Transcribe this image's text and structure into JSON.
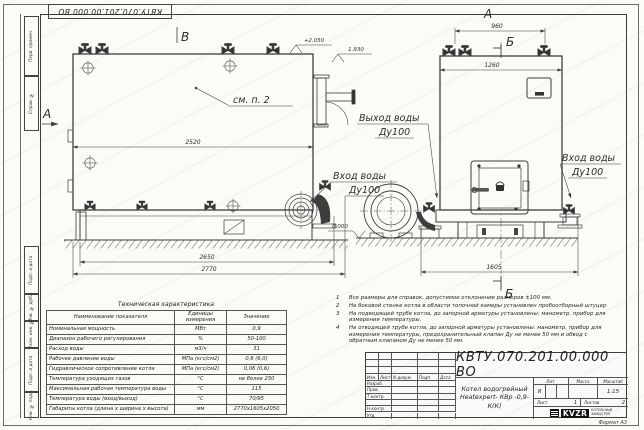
{
  "frame": {
    "doc_number": "КВТУ.070.201.00.000  ВО",
    "format_label": "Формат  А3",
    "margin_labels": [
      "Перв. примен.",
      "Справ. №",
      "Подп. и дата",
      "Инв. № дубл.",
      "Взам. инв. №",
      "Подп. и дата",
      "Инв. № подл."
    ]
  },
  "views": {
    "side": {
      "view_mark_top": "В",
      "section_mark_left": "А",
      "note_ref": "см. п. 2",
      "dim_inner": "2520",
      "dim_base": "2650",
      "dim_total": "2770",
      "elev_top": "+2.050",
      "elev_outlet": "1.930",
      "elev_ground": "0.000"
    },
    "front": {
      "view_mark_top": "А",
      "section_mark_top": "Б",
      "section_mark_bottom": "Б",
      "dim_valves": "960",
      "dim_width": "1260",
      "dim_base": "1605"
    },
    "callouts": {
      "outlet_line1": "Выход воды",
      "outlet_line2": "Ду100",
      "inlet_side_line1": "Вход воды",
      "inlet_side_line2": "Ду100",
      "inlet_front_line1": "Вход воды",
      "inlet_front_line2": "Ду100"
    }
  },
  "notes": {
    "items": [
      {
        "num": "1",
        "text": "Все размеры для справок, допустимое отклонение размеров ±100 мм."
      },
      {
        "num": "2",
        "text": "На боковой стенке котла в области топочной камеры установлен пробоотборный штуцер"
      },
      {
        "num": "3",
        "text": "На подводящей трубе котла, до запорной арматуры установлены: манометр, прибор для измерения температуры."
      },
      {
        "num": "4",
        "text": "На отводящей трубе котла, до запорной арматуры установлены: манометр, прибор для измерения температуры, предохранительный клапан Ду не менее 50 мм и обвод с обратным клапаном Ду не менее 50 мм."
      }
    ]
  },
  "tech_table": {
    "title": "Техническая характеристика",
    "headers": {
      "name": "Наименование показателя",
      "unit": "Единицы измерения",
      "value": "Значение"
    },
    "rows": [
      {
        "name": "Номинальная мощность",
        "unit": "МВт",
        "value": "0,9"
      },
      {
        "name": "Диапазон рабочего регулирования",
        "unit": "%",
        "value": "50-100"
      },
      {
        "name": "Расход воды",
        "unit": "м3/ч",
        "value": "31"
      },
      {
        "name": "Рабочее давление воды",
        "unit": "МПа (кгс/см2)",
        "value": "0,6 (6,0)"
      },
      {
        "name": "Гидравлическое сопротивление котла",
        "unit": "МПа (кгс/см2)",
        "value": "0,06 (0,6)"
      },
      {
        "name": "Температура уходящих газов",
        "unit": "°С",
        "value": "не более 250"
      },
      {
        "name": "Максимальная рабочая температура воды",
        "unit": "°С",
        "value": "115"
      },
      {
        "name": "Температура воды (вход/выход)",
        "unit": "°С",
        "value": "70/95"
      },
      {
        "name": "Габариты котла (длина х ширина х высота)",
        "unit": "мм",
        "value": "2770х1605х2050"
      }
    ]
  },
  "title_block": {
    "doc_number": "КВТУ.070.201.00.000  ВО",
    "product_name_line1": "Котел водогрейный",
    "product_name_line2": "Heatexpert- КВр -0,9- К(К)",
    "header_cols": {
      "izm": "Изм.",
      "list": "Лист",
      "doc": "N докум.",
      "podp": "Подп.",
      "data": "Дата"
    },
    "row_labels": [
      "Разраб.",
      "Пров.",
      "Т.контр.",
      "",
      "Н.контр.",
      "Утв."
    ],
    "lit_header": "Лит.",
    "mass_header": "Масса",
    "scale_header": "Масштаб",
    "lit_value": "И",
    "scale_value": "1:15",
    "sheet_label": "Лист",
    "sheet_value": "1",
    "sheets_label": "Листов",
    "sheets_value": "2",
    "logo_text": "KVZR",
    "logo_caption_line1": "КОТЕЛЬНЫЙ",
    "logo_caption_line2": "ЗАВОД РЭП"
  }
}
